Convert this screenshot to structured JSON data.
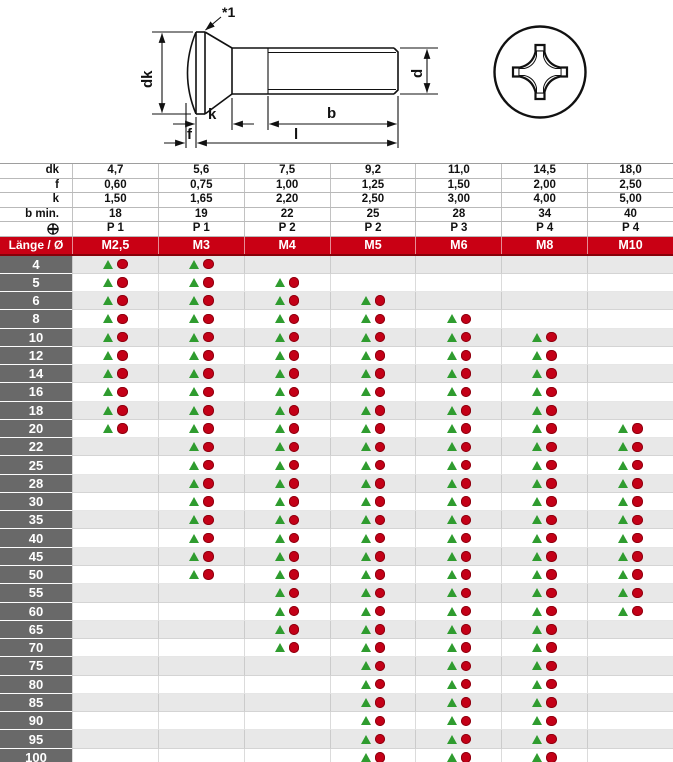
{
  "drawing": {
    "annotation": "*1",
    "labels": {
      "dk": "dk",
      "f": "f",
      "k": "k",
      "b": "b",
      "l": "l",
      "d": "d"
    }
  },
  "spec_table": {
    "rows": [
      {
        "label": "dk",
        "values": [
          "4,7",
          "5,6",
          "7,5",
          "9,2",
          "11,0",
          "14,5",
          "18,0"
        ]
      },
      {
        "label": "f",
        "values": [
          "0,60",
          "0,75",
          "1,00",
          "1,25",
          "1,50",
          "2,00",
          "2,50"
        ]
      },
      {
        "label": "k",
        "values": [
          "1,50",
          "1,65",
          "2,20",
          "2,50",
          "3,00",
          "4,00",
          "5,00"
        ]
      },
      {
        "label": "b min.",
        "values": [
          "18",
          "19",
          "22",
          "25",
          "28",
          "34",
          "40"
        ]
      },
      {
        "label": "",
        "icon": "phillips-icon",
        "values": [
          "P 1",
          "P 1",
          "P 2",
          "P 2",
          "P 3",
          "P 4",
          "P 4"
        ]
      }
    ]
  },
  "size_header": {
    "corner": "Länge / Ø",
    "columns": [
      "M2,5",
      "M3",
      "M4",
      "M5",
      "M6",
      "M8",
      "M10"
    ]
  },
  "availability": {
    "symbols": {
      "triangle": "▲",
      "circle": "●"
    },
    "rows": [
      {
        "length": "4",
        "cells": [
          1,
          1,
          0,
          0,
          0,
          0,
          0
        ]
      },
      {
        "length": "5",
        "cells": [
          1,
          1,
          1,
          0,
          0,
          0,
          0
        ]
      },
      {
        "length": "6",
        "cells": [
          1,
          1,
          1,
          1,
          0,
          0,
          0
        ]
      },
      {
        "length": "8",
        "cells": [
          1,
          1,
          1,
          1,
          1,
          0,
          0
        ]
      },
      {
        "length": "10",
        "cells": [
          1,
          1,
          1,
          1,
          1,
          1,
          0
        ]
      },
      {
        "length": "12",
        "cells": [
          1,
          1,
          1,
          1,
          1,
          1,
          0
        ]
      },
      {
        "length": "14",
        "cells": [
          1,
          1,
          1,
          1,
          1,
          1,
          0
        ]
      },
      {
        "length": "16",
        "cells": [
          1,
          1,
          1,
          1,
          1,
          1,
          0
        ]
      },
      {
        "length": "18",
        "cells": [
          1,
          1,
          1,
          1,
          1,
          1,
          0
        ]
      },
      {
        "length": "20",
        "cells": [
          1,
          1,
          1,
          1,
          1,
          1,
          1
        ]
      },
      {
        "length": "22",
        "cells": [
          0,
          1,
          1,
          1,
          1,
          1,
          1
        ]
      },
      {
        "length": "25",
        "cells": [
          0,
          1,
          1,
          1,
          1,
          1,
          1
        ]
      },
      {
        "length": "28",
        "cells": [
          0,
          1,
          1,
          1,
          1,
          1,
          1
        ]
      },
      {
        "length": "30",
        "cells": [
          0,
          1,
          1,
          1,
          1,
          1,
          1
        ]
      },
      {
        "length": "35",
        "cells": [
          0,
          1,
          1,
          1,
          1,
          1,
          1
        ]
      },
      {
        "length": "40",
        "cells": [
          0,
          1,
          1,
          1,
          1,
          1,
          1
        ]
      },
      {
        "length": "45",
        "cells": [
          0,
          1,
          1,
          1,
          1,
          1,
          1
        ]
      },
      {
        "length": "50",
        "cells": [
          0,
          1,
          1,
          1,
          1,
          1,
          1
        ]
      },
      {
        "length": "55",
        "cells": [
          0,
          0,
          1,
          1,
          1,
          1,
          1
        ]
      },
      {
        "length": "60",
        "cells": [
          0,
          0,
          1,
          1,
          1,
          1,
          1
        ]
      },
      {
        "length": "65",
        "cells": [
          0,
          0,
          1,
          1,
          1,
          1,
          0
        ]
      },
      {
        "length": "70",
        "cells": [
          0,
          0,
          1,
          1,
          1,
          1,
          0
        ]
      },
      {
        "length": "75",
        "cells": [
          0,
          0,
          0,
          1,
          1,
          1,
          0
        ]
      },
      {
        "length": "80",
        "cells": [
          0,
          0,
          0,
          1,
          1,
          1,
          0
        ]
      },
      {
        "length": "85",
        "cells": [
          0,
          0,
          0,
          1,
          1,
          1,
          0
        ]
      },
      {
        "length": "90",
        "cells": [
          0,
          0,
          0,
          1,
          1,
          1,
          0
        ]
      },
      {
        "length": "95",
        "cells": [
          0,
          0,
          0,
          1,
          1,
          1,
          0
        ]
      },
      {
        "length": "100",
        "cells": [
          0,
          0,
          0,
          1,
          1,
          1,
          0
        ]
      }
    ]
  },
  "colors": {
    "header_red": "#c90014",
    "header_red_dark": "#870009",
    "row_gray": "#e8e8e8",
    "label_gray": "#696969",
    "triangle_green": "#2f9c2f",
    "circle_red": "#c40017"
  }
}
